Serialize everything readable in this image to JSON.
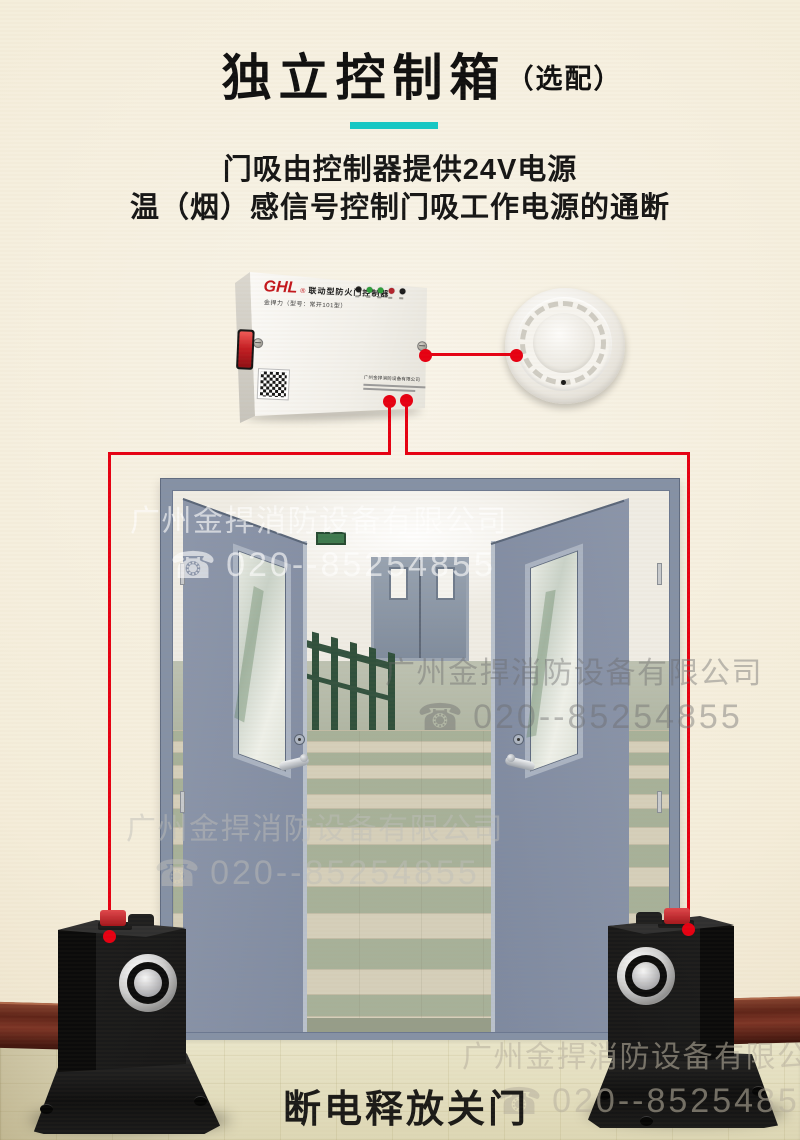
{
  "header": {
    "title": "独立控制箱",
    "title_suffix": "（选配）",
    "divider_color": "#15c8c5",
    "subtitle_line1": "门吸由控制器提供24V电源",
    "subtitle_line2": "温（烟）感信号控制门吸工作电源的通断"
  },
  "controller": {
    "brand": "GHL",
    "reg_mark": "®",
    "product_name": "联动型防火门控制器",
    "model_line": "金捍力（型号：常开101型）",
    "label_company": "广州金捍消防设备有限公司",
    "led_colors": [
      "#1c1c1c",
      "#2f9e3c",
      "#2f9e3c",
      "#b2232b",
      "#1c1c1c"
    ]
  },
  "wiring": {
    "color": "#e60012"
  },
  "watermark": {
    "company": "广州金捍消防设备有限公司",
    "phone_icon": "☎",
    "phone": "020--85254855"
  },
  "caption": "断电释放关门"
}
